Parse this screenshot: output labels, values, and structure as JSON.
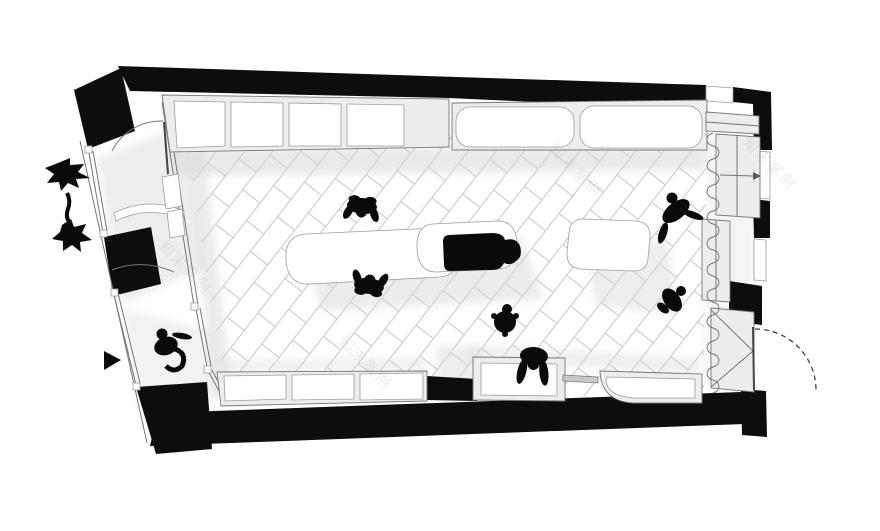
{
  "canvas": {
    "width": 880,
    "height": 531,
    "background": "#ffffff"
  },
  "colors": {
    "wall": "#0d0d0d",
    "outline": "#767676",
    "furniture_frame": "#ededed",
    "panel": "#ffffff",
    "tile_line": "#c6c6c6",
    "shadow": "#d9d9d9",
    "figure": "#0a0a0a",
    "dashed_door": "#333333",
    "wm": "#8f8f8f"
  },
  "watermark": {
    "text": "知末案例",
    "opacity": 0.16
  }
}
